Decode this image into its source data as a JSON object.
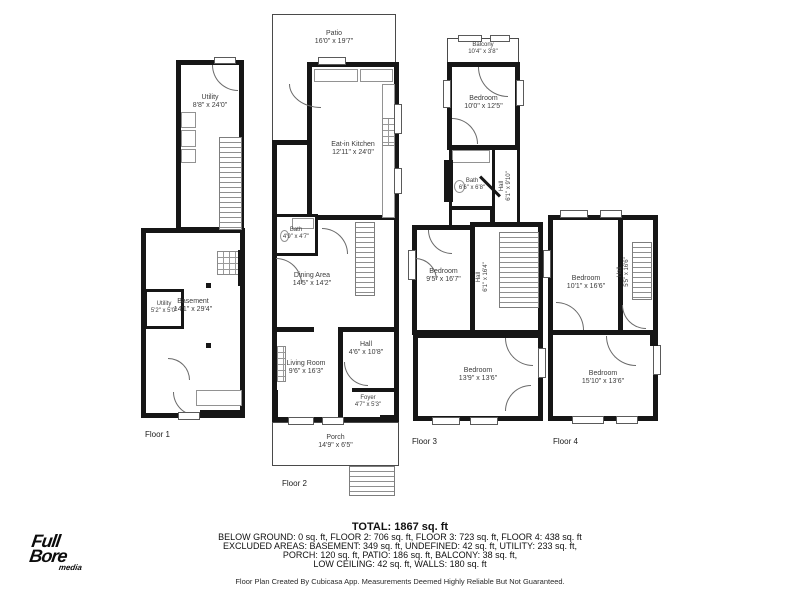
{
  "floors": [
    {
      "label": "Floor 1",
      "rooms": {
        "utility": {
          "name": "Utility",
          "dims": "8'8\" x 24'0\""
        },
        "basement": {
          "name": "Basement",
          "dims": "14'1\" x 29'4\""
        },
        "utility_small": {
          "name": "Utility",
          "dims": "5'2\" x 5'0\""
        }
      }
    },
    {
      "label": "Floor 2",
      "rooms": {
        "patio": {
          "name": "Patio",
          "dims": "16'0\" x 19'7\""
        },
        "kitchen": {
          "name": "Eat-in Kitchen",
          "dims": "12'11\" x 24'0\""
        },
        "bath": {
          "name": "Bath",
          "dims": "4'9\" x 4'7\""
        },
        "dining": {
          "name": "Dining Area",
          "dims": "14'5\" x 14'2\""
        },
        "hall": {
          "name": "Hall",
          "dims": "4'6\" x 10'8\""
        },
        "living": {
          "name": "Living Room",
          "dims": "9'6\" x 16'3\""
        },
        "foyer": {
          "name": "Foyer",
          "dims": "4'7\" x 5'3\""
        },
        "porch": {
          "name": "Porch",
          "dims": "14'9\" x 6'5\""
        }
      }
    },
    {
      "label": "Floor 3",
      "rooms": {
        "balcony": {
          "name": "Balcony",
          "dims": "10'4\" x 3'8\""
        },
        "bedroom_top": {
          "name": "Bedroom",
          "dims": "10'0\" x 12'5\""
        },
        "bath": {
          "name": "Bath",
          "dims": "6'6\" x 6'8\""
        },
        "hall_upper": {
          "name": "Hall",
          "dims": "6'1\" x 9'10\""
        },
        "bedroom_mid": {
          "name": "Bedroom",
          "dims": "9'5\" x 16'7\""
        },
        "hall_lower": {
          "name": "Hall",
          "dims": "6'1\" x 16'4\""
        },
        "bedroom_bottom": {
          "name": "Bedroom",
          "dims": "13'9\" x 13'6\""
        }
      }
    },
    {
      "label": "Floor 4",
      "rooms": {
        "bedroom_top": {
          "name": "Bedroom",
          "dims": "10'1\" x 16'6\""
        },
        "hall": {
          "name": "Hall",
          "dims": "5'5\" x 16'6\""
        },
        "bedroom_bottom": {
          "name": "Bedroom",
          "dims": "15'10\" x 13'6\""
        }
      }
    }
  ],
  "summary": {
    "total": "TOTAL: 1867 sq. ft",
    "line1": "BELOW GROUND: 0 sq. ft, FLOOR 2: 706 sq. ft, FLOOR 3: 723 sq. ft, FLOOR 4: 438 sq. ft",
    "line2": "EXCLUDED AREAS: BASEMENT: 349 sq. ft, UNDEFINED: 42 sq. ft, UTILITY: 233 sq. ft,",
    "line3": "PORCH: 120 sq. ft, PATIO: 186 sq. ft, BALCONY: 38 sq. ft,",
    "line4": "LOW CEILING: 42 sq. ft, WALLS: 180 sq. ft",
    "disclaimer": "Floor Plan Created By Cubicasa App. Measurements Deemed Highly Reliable But Not Guaranteed."
  },
  "logo": {
    "l1": "Full",
    "l2": "Bore",
    "l3": "media"
  },
  "colors": {
    "wall": "#161616",
    "label": "#3c3c3c",
    "background": "#ffffff"
  }
}
